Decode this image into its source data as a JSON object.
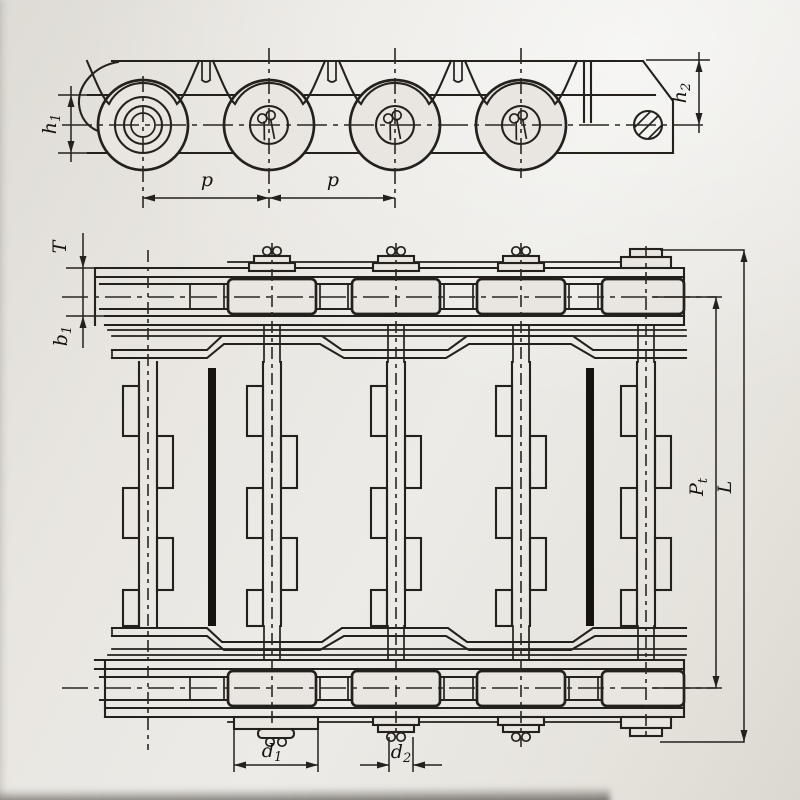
{
  "colors": {
    "background": "#e9e6e1",
    "ink": "#24211d"
  },
  "views": {
    "side_view": {
      "description": "chain side elevation",
      "dimensions": {
        "h1": {
          "base": "h",
          "sub": "1"
        },
        "p_left": {
          "base": "p",
          "sub": ""
        },
        "p_right": {
          "base": "p",
          "sub": ""
        },
        "h2": {
          "base": "h",
          "sub": "2"
        }
      }
    },
    "plan_view": {
      "description": "chain plan view with slats",
      "dimensions": {
        "T": {
          "base": "T",
          "sub": ""
        },
        "b1": {
          "base": "b",
          "sub": "1"
        },
        "Pt": {
          "base": "P",
          "sub": "t"
        },
        "L": {
          "base": "L",
          "sub": ""
        },
        "d1": {
          "base": "d",
          "sub": "1"
        },
        "d2": {
          "base": "d",
          "sub": "2"
        }
      }
    }
  }
}
